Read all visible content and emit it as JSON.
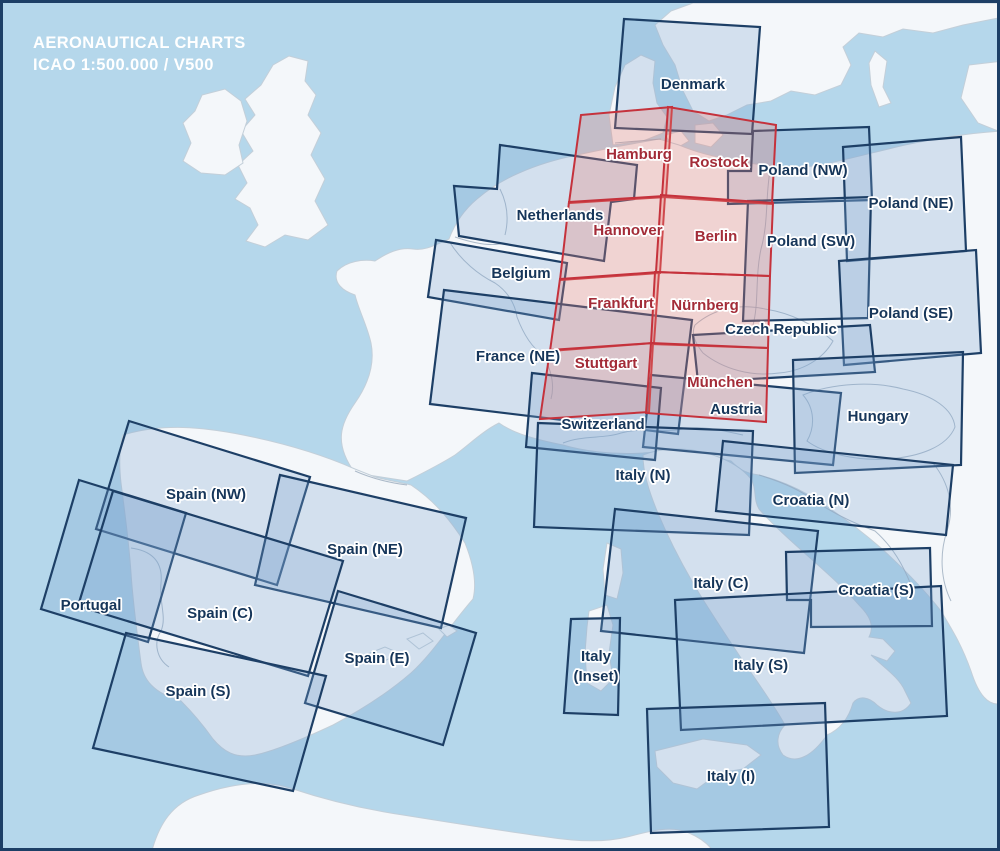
{
  "title": {
    "line1": "AERONAUTICAL CHARTS",
    "line2": "ICAO 1:500.000 / V500"
  },
  "colors": {
    "sea": "#b5d7eb",
    "land": "#f4f7fa",
    "frame_navy": "#1d3f66",
    "eu_stroke": "#1d3f66",
    "eu_fill": "rgba(125,165,210,0.28)",
    "de_stroke": "#c5323c",
    "de_fill": "rgba(232,130,120,0.30)",
    "eu_label_color": "#16365a",
    "de_label_color": "#a32c38",
    "title_color": "#ffffff"
  },
  "charts": [
    {
      "label": "Denmark",
      "series": "eu",
      "points": [
        [
          621,
          16
        ],
        [
          757,
          24
        ],
        [
          749,
          131
        ],
        [
          612,
          125
        ]
      ],
      "label_pos": [
        690,
        86
      ]
    },
    {
      "label": "Hamburg",
      "series": "de",
      "points": [
        [
          578,
          112
        ],
        [
          669,
          104
        ],
        [
          663,
          194
        ],
        [
          566,
          200
        ]
      ],
      "label_pos": [
        636,
        156
      ]
    },
    {
      "label": "Rostock",
      "series": "de",
      "points": [
        [
          665,
          104
        ],
        [
          773,
          122
        ],
        [
          769,
          201
        ],
        [
          659,
          194
        ]
      ],
      "label_pos": [
        716,
        164
      ]
    },
    {
      "label": "Poland (NW)",
      "series": "eu",
      "points": [
        [
          750,
          128
        ],
        [
          866,
          124
        ],
        [
          869,
          197
        ],
        [
          725,
          201
        ],
        [
          725,
          168
        ],
        [
          748,
          168
        ]
      ],
      "label_pos": [
        800,
        172
      ]
    },
    {
      "label": "Poland (NE)",
      "series": "eu",
      "points": [
        [
          840,
          144
        ],
        [
          958,
          134
        ],
        [
          963,
          248
        ],
        [
          844,
          258
        ]
      ],
      "label_pos": [
        908,
        205
      ]
    },
    {
      "label": "Netherlands",
      "series": "eu",
      "points": [
        [
          497,
          142
        ],
        [
          634,
          162
        ],
        [
          631,
          196
        ],
        [
          608,
          199
        ],
        [
          601,
          258
        ],
        [
          456,
          233
        ],
        [
          451,
          183
        ],
        [
          494,
          186
        ]
      ],
      "label_pos": [
        557,
        217
      ]
    },
    {
      "label": "Hannover",
      "series": "de",
      "points": [
        [
          566,
          199
        ],
        [
          662,
          193
        ],
        [
          657,
          270
        ],
        [
          557,
          277
        ]
      ],
      "label_pos": [
        625,
        232
      ]
    },
    {
      "label": "Berlin",
      "series": "de",
      "points": [
        [
          658,
          192
        ],
        [
          770,
          200
        ],
        [
          767,
          273
        ],
        [
          653,
          269
        ]
      ],
      "label_pos": [
        713,
        238
      ]
    },
    {
      "label": "Poland (SW)",
      "series": "eu",
      "points": [
        [
          745,
          198
        ],
        [
          868,
          194
        ],
        [
          865,
          315
        ],
        [
          740,
          318
        ]
      ],
      "label_pos": [
        808,
        243
      ]
    },
    {
      "label": "Belgium",
      "series": "eu",
      "points": [
        [
          433,
          237
        ],
        [
          564,
          260
        ],
        [
          556,
          317
        ],
        [
          425,
          294
        ]
      ],
      "label_pos": [
        518,
        275
      ]
    },
    {
      "label": "Frankfurt",
      "series": "de",
      "points": [
        [
          557,
          276
        ],
        [
          656,
          269
        ],
        [
          651,
          340
        ],
        [
          547,
          348
        ]
      ],
      "label_pos": [
        618,
        305
      ]
    },
    {
      "label": "Nürnberg",
      "series": "de",
      "points": [
        [
          652,
          269
        ],
        [
          767,
          273
        ],
        [
          765,
          345
        ],
        [
          648,
          341
        ]
      ],
      "label_pos": [
        702,
        307
      ]
    },
    {
      "label": "Poland (SE)",
      "series": "eu",
      "points": [
        [
          836,
          258
        ],
        [
          973,
          247
        ],
        [
          978,
          350
        ],
        [
          841,
          362
        ]
      ],
      "label_pos": [
        908,
        315
      ]
    },
    {
      "label": "Czech Republic",
      "series": "eu",
      "points": [
        [
          690,
          332
        ],
        [
          867,
          322
        ],
        [
          872,
          369
        ],
        [
          695,
          379
        ]
      ],
      "label_pos": [
        778,
        331
      ]
    },
    {
      "label": "France (NE)",
      "series": "eu",
      "points": [
        [
          441,
          287
        ],
        [
          689,
          317
        ],
        [
          675,
          431
        ],
        [
          427,
          401
        ]
      ],
      "label_pos": [
        515,
        358
      ]
    },
    {
      "label": "Stuttgart",
      "series": "de",
      "points": [
        [
          547,
          347
        ],
        [
          650,
          340
        ],
        [
          646,
          409
        ],
        [
          537,
          416
        ]
      ],
      "label_pos": [
        603,
        365
      ]
    },
    {
      "label": "München",
      "series": "de",
      "points": [
        [
          648,
          340
        ],
        [
          765,
          345
        ],
        [
          763,
          419
        ],
        [
          643,
          410
        ]
      ],
      "label_pos": [
        717,
        384
      ]
    },
    {
      "label": "Austria",
      "series": "eu",
      "points": [
        [
          648,
          372
        ],
        [
          838,
          390
        ],
        [
          830,
          462
        ],
        [
          640,
          444
        ]
      ],
      "label_pos": [
        733,
        411
      ]
    },
    {
      "label": "Switzerland",
      "series": "eu",
      "points": [
        [
          529,
          370
        ],
        [
          658,
          385
        ],
        [
          652,
          457
        ],
        [
          523,
          444
        ]
      ],
      "label_pos": [
        600,
        426
      ]
    },
    {
      "label": "Hungary",
      "series": "eu",
      "points": [
        [
          790,
          357
        ],
        [
          960,
          349
        ],
        [
          958,
          462
        ],
        [
          792,
          470
        ]
      ],
      "label_pos": [
        875,
        418
      ]
    },
    {
      "label": "Italy (N)",
      "series": "eu",
      "points": [
        [
          535,
          420
        ],
        [
          750,
          428
        ],
        [
          746,
          532
        ],
        [
          531,
          524
        ]
      ],
      "label_pos": [
        640,
        477
      ]
    },
    {
      "label": "Croatia (N)",
      "series": "eu",
      "points": [
        [
          720,
          438
        ],
        [
          950,
          462
        ],
        [
          943,
          532
        ],
        [
          713,
          508
        ]
      ],
      "label_pos": [
        808,
        502
      ]
    },
    {
      "label": "Spain (NW)",
      "series": "eu",
      "points": [
        [
          126,
          418
        ],
        [
          307,
          474
        ],
        [
          274,
          582
        ],
        [
          93,
          526
        ]
      ],
      "label_pos": [
        203,
        496
      ]
    },
    {
      "label": "Spain (NE)",
      "series": "eu",
      "points": [
        [
          277,
          472
        ],
        [
          463,
          515
        ],
        [
          438,
          625
        ],
        [
          252,
          582
        ]
      ],
      "label_pos": [
        362,
        551
      ]
    },
    {
      "label": "Italy (C)",
      "series": "eu",
      "points": [
        [
          612,
          506
        ],
        [
          815,
          528
        ],
        [
          801,
          650
        ],
        [
          598,
          628
        ]
      ],
      "label_pos": [
        718,
        585
      ]
    },
    {
      "label": "Croatia (S)",
      "series": "eu",
      "points": [
        [
          783,
          549
        ],
        [
          927,
          545
        ],
        [
          929,
          623
        ],
        [
          808,
          624
        ],
        [
          808,
          597
        ],
        [
          784,
          597
        ]
      ],
      "label_pos": [
        873,
        592
      ]
    },
    {
      "label": "Portugal",
      "series": "eu",
      "points": [
        [
          76,
          477
        ],
        [
          183,
          510
        ],
        [
          145,
          639
        ],
        [
          38,
          606
        ]
      ],
      "label_pos": [
        88,
        607
      ]
    },
    {
      "label": "Spain (C)",
      "series": "eu",
      "points": [
        [
          110,
          488
        ],
        [
          340,
          558
        ],
        [
          305,
          673
        ],
        [
          75,
          603
        ]
      ],
      "label_pos": [
        217,
        615
      ]
    },
    {
      "label": "Spain (E)",
      "series": "eu",
      "points": [
        [
          335,
          588
        ],
        [
          473,
          630
        ],
        [
          440,
          742
        ],
        [
          302,
          700
        ]
      ],
      "label_pos": [
        374,
        660
      ]
    },
    {
      "label": "Italy (Inset)",
      "series": "eu",
      "points": [
        [
          568,
          616
        ],
        [
          617,
          615
        ],
        [
          615,
          712
        ],
        [
          561,
          710
        ]
      ],
      "label_pos": [
        593,
        663
      ],
      "label_lines": [
        "Italy",
        "(Inset)"
      ]
    },
    {
      "label": "Italy (S)",
      "series": "eu",
      "points": [
        [
          672,
          597
        ],
        [
          938,
          583
        ],
        [
          944,
          713
        ],
        [
          678,
          727
        ]
      ],
      "label_pos": [
        758,
        667
      ]
    },
    {
      "label": "Spain (S)",
      "series": "eu",
      "points": [
        [
          123,
          630
        ],
        [
          323,
          673
        ],
        [
          290,
          788
        ],
        [
          90,
          745
        ]
      ],
      "label_pos": [
        195,
        693
      ]
    },
    {
      "label": "Italy (I)",
      "series": "eu",
      "points": [
        [
          644,
          706
        ],
        [
          822,
          700
        ],
        [
          826,
          824
        ],
        [
          648,
          830
        ]
      ],
      "label_pos": [
        728,
        778
      ]
    }
  ]
}
